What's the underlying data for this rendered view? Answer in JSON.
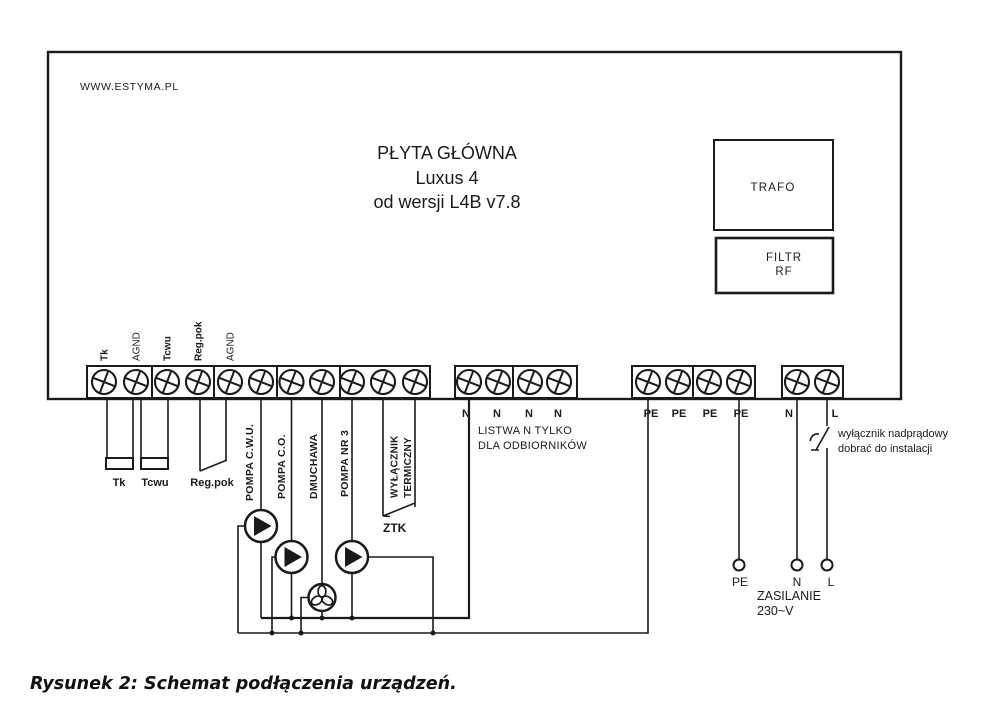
{
  "board": {
    "website": "WWW.ESTYMA.PL",
    "title1": "PŁYTA GŁÓWNA",
    "title2": "Luxus 4",
    "title3": "od wersji L4B v7.8",
    "trafo": "TRAFO",
    "filtr1": "FILTR",
    "filtr2": "RF"
  },
  "left_strip": {
    "terminal_labels": [
      "Tk",
      "AGND",
      "Tcwu",
      "Reg.pok",
      "AGND"
    ]
  },
  "outputs": {
    "labels": [
      "POMPA C.W.U.",
      "POMPA C.O.",
      "DMUCHAWA",
      "POMPA NR 3"
    ],
    "thermal1": "WYŁĄCZNIK",
    "thermal2": "TERMICZNY",
    "ztk": "ZTK"
  },
  "sensors": {
    "tk": "Tk",
    "tcwu": "Tcwu",
    "regpok": "Reg.pok"
  },
  "neutral": {
    "labels": [
      "N",
      "N",
      "N",
      "N"
    ],
    "note1": "LISTWA N TYLKO",
    "note2": "DLA ODBIORNIKÓW"
  },
  "pe": {
    "labels": [
      "PE",
      "PE",
      "PE",
      "PE"
    ]
  },
  "mains": {
    "n": "N",
    "l": "L"
  },
  "supply": {
    "pe": "PE",
    "n": "N",
    "l": "L",
    "name": "ZASILANIE",
    "voltage": "230~V"
  },
  "note": {
    "line1": "wyłącznik nadprądowy",
    "line2": "dobrać do instalacji"
  },
  "caption": "Rysunek 2: Schemat podłączenia urządzeń.",
  "colors": {
    "ink": "#1a1a1a",
    "paper": "#ffffff"
  }
}
